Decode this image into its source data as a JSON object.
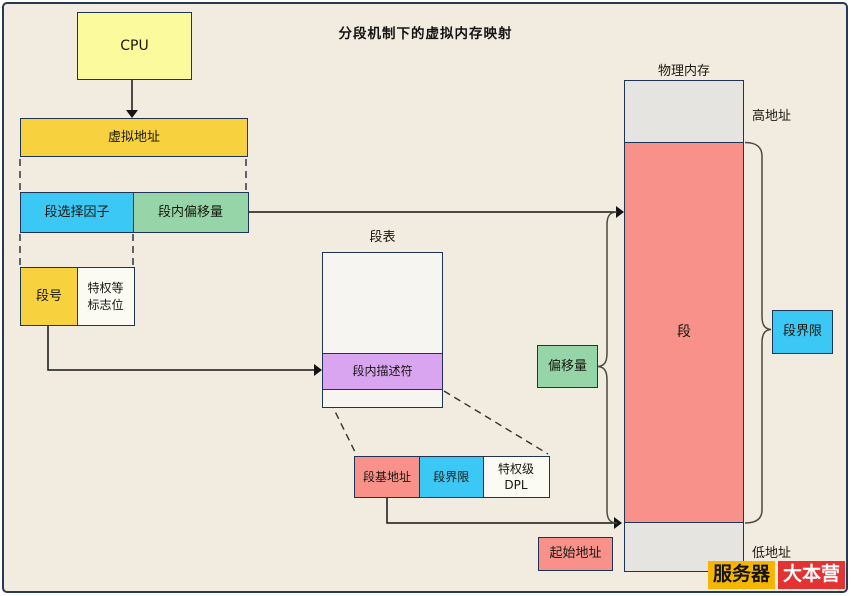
{
  "title": "分段机制下的虚拟内存映射",
  "cpu": {
    "label": "CPU"
  },
  "virtual_address": {
    "label": "虚拟地址"
  },
  "selector": {
    "label": "段选择因子"
  },
  "inner_offset": {
    "label": "段内偏移量"
  },
  "segment_number": {
    "label": "段号"
  },
  "privilege_flags": {
    "line1": "特权等",
    "line2": "标志位"
  },
  "segment_table": {
    "label": "段表",
    "descriptor": "段内描述符"
  },
  "descriptor_detail": {
    "base_address": "段基地址",
    "limit": "段界限",
    "dpl_line1": "特权级",
    "dpl_line2": "DPL"
  },
  "offset_brace_label": "偏移量",
  "physical_memory": {
    "label": "物理内存",
    "segment": "段",
    "high_address": "高地址",
    "low_address": "低地址",
    "start_address": "起始地址",
    "segment_limit": "段界限"
  },
  "watermark": {
    "part1": "服务器",
    "part2": "大本营"
  },
  "colors": {
    "background": "#f2ece0",
    "frame_border": "#24395c",
    "box_border": "#1f3455",
    "light_yellow": "#fbfb9e",
    "gold": "#f7d23e",
    "cyan": "#3cc8f4",
    "green": "#95d5a7",
    "purple": "#d9a4f0",
    "salmon": "#f9918b",
    "gray": "#e5e4e1",
    "logo_yellow": "#f5b501",
    "logo_red": "#e23231"
  }
}
